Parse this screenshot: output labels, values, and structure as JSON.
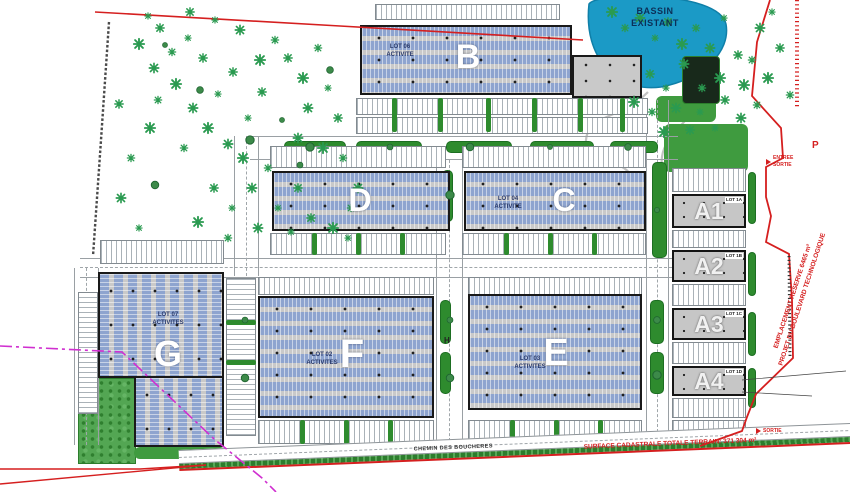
{
  "pond": {
    "label": "BASSIN\nEXISTANT"
  },
  "buildings": {
    "b": {
      "letter": "B",
      "lot": "LOT 06\nACTIVITE"
    },
    "c": {
      "letter": "C",
      "lot": "LOT 04\nACTIVITE"
    },
    "d": {
      "letter": "D"
    },
    "e": {
      "letter": "E",
      "lot": "LOT 03\nACTIVITES"
    },
    "f": {
      "letter": "F",
      "lot": "LOT 02\nACTIVITES"
    },
    "g": {
      "letter": "G",
      "lot": "LOT 07\nACTIVITES"
    },
    "a1": {
      "letter": "A1",
      "lot": "LOT 1A"
    },
    "a2": {
      "letter": "A2",
      "lot": "LOT 1B"
    },
    "a3": {
      "letter": "A3",
      "lot": "LOT 1C"
    },
    "a4": {
      "letter": "A4",
      "lot": "LOT 1D"
    }
  },
  "annotations": {
    "entree_sortie": "ENTREE\nSORTIE",
    "sortie": "SORTIE",
    "parking_p": "P",
    "hydrant_h": "H",
    "reserve_line1": "EMPLACEMENT RESERVE 6465 m²",
    "reserve_line2": "PROJET DU BOULEVARD TECHNOLOGIQUE",
    "road_name": "CHEMIN DES BOUCHERES",
    "surface_total": "SURFACE CADASTRALE TOTALE TERRAIN: 371 304 m²"
  },
  "colors": {
    "water": "#1b9ac6",
    "panel_blue": "#8ea4cf",
    "green": "#2e8b2e",
    "boundary_red": "#d51f1f",
    "limit_magenta": "#d02fd0"
  }
}
